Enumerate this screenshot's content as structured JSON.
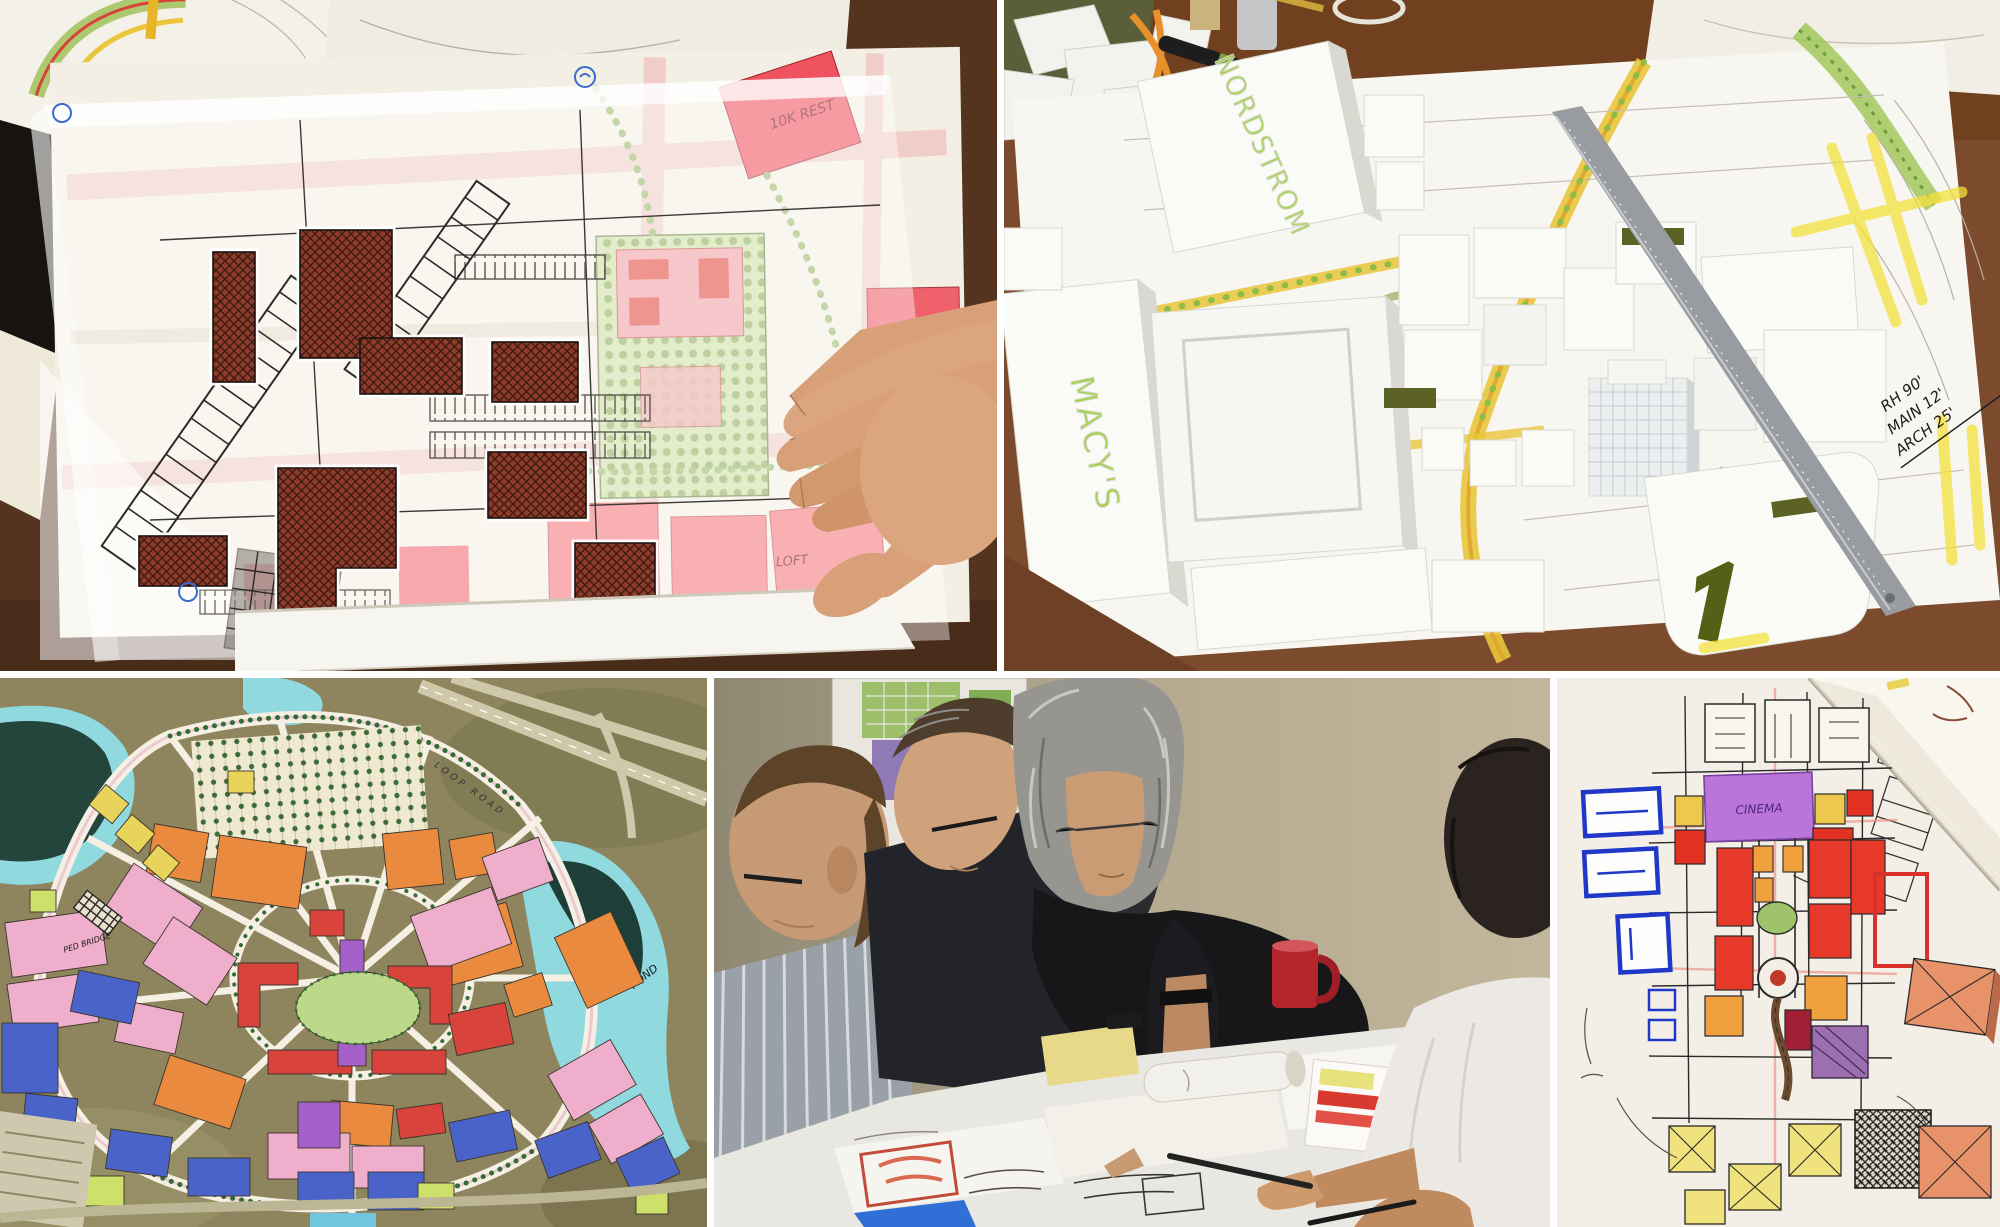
{
  "collage": {
    "gutter_color": "#ffffff",
    "panels": {
      "trace_sketch": {
        "labels": {
          "rest": "10K REST",
          "loft": "LOFT"
        }
      },
      "foam_model": {
        "labels": {
          "nordstrom": "NORDSTROM",
          "macys": "MACY'S"
        },
        "annotations": {
          "line1": "RH 90'",
          "line2": "MAIN 12'",
          "line3": "ARCH 25'"
        }
      },
      "master_plan": {
        "labels": {
          "pond": "POND",
          "ped_bridge": "PED BRIDGE",
          "loop_road": "LOOP ROAD"
        }
      },
      "design_meeting": {},
      "color_sketch": {
        "labels": {
          "cinema": "CINEMA"
        }
      }
    },
    "palette": {
      "wood_dark": "#54341f",
      "wood_mid": "#7c4a2c",
      "paper": "#f5f2ea",
      "trace_white": "#ffffff",
      "brick_hatch": "#8f3b2a",
      "parcel_red": "#ef5360",
      "parcel_pink": "#f4848c",
      "landscape_green": "#b5c46a",
      "road_yellow": "#e9c63b",
      "foam_white": "#fafaf7",
      "foam_shadow": "#d9d9d2",
      "roof_olive": "#5c6224",
      "ruler_gray": "#989ca0",
      "highlighter_yellow": "#f3e13c",
      "marker_green_text": "#a4d24c",
      "aerial_olive": "#8e855e",
      "water_cyan": "#8fd9df",
      "water_dark": "#23453c",
      "block_orange": "#e98a3e",
      "block_pink": "#efafcc",
      "block_red": "#d8433b",
      "block_purple": "#a560c9",
      "block_blue": "#4a63c8",
      "block_yellow": "#e9d45b",
      "tree_green": "#2f6632",
      "wall_beige": "#b3a78e",
      "sweater_black": "#17171a",
      "skin": "#c79a76",
      "shirt_white": "#ece9e4",
      "mug_red": "#b5252b",
      "pencil_red": "#c0392b",
      "sketch_ink": "#2a2a2a",
      "cinema_purple": "#b975d9",
      "blue_outline": "#2038c8"
    }
  }
}
